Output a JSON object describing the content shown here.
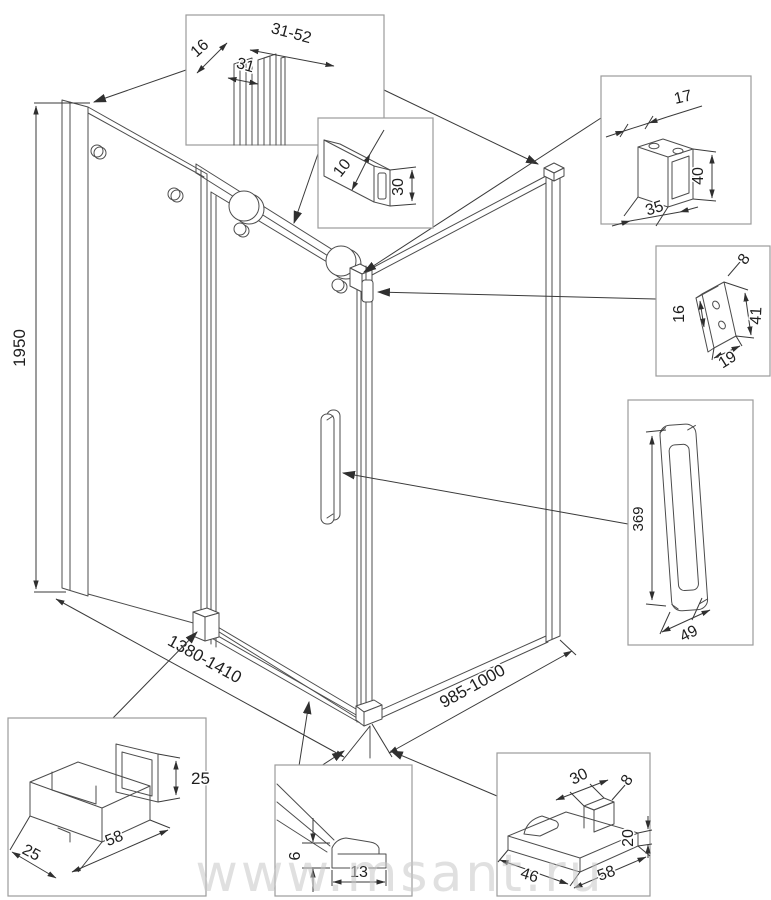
{
  "diagram": {
    "watermark": "www.msant.ru",
    "main_view": {
      "dimensions": {
        "height": "1950",
        "front_width": "1380-1410",
        "side_width": "985-1000"
      }
    },
    "callouts": {
      "wall_profile": {
        "width_range": "31-52",
        "inner_width": "31",
        "depth": "16"
      },
      "top_rail_tube": {
        "wall_thickness": "10",
        "height": "30"
      },
      "roller_housing": {
        "depth": "17",
        "width": "35",
        "height": "40"
      },
      "wall_bracket": {
        "hole_spacing": "16",
        "hole_diameter": "8",
        "height": "41",
        "width": "19"
      },
      "door_handle": {
        "length": "369",
        "width": "49"
      },
      "bottom_guide": {
        "height": "25",
        "length": "58",
        "width": "25"
      },
      "threshold_profile": {
        "height": "6",
        "width": "13"
      },
      "bottom_bumper": {
        "top_width": "30",
        "hole_diameter": "8",
        "height": "20",
        "width": "46",
        "length": "58"
      }
    }
  }
}
